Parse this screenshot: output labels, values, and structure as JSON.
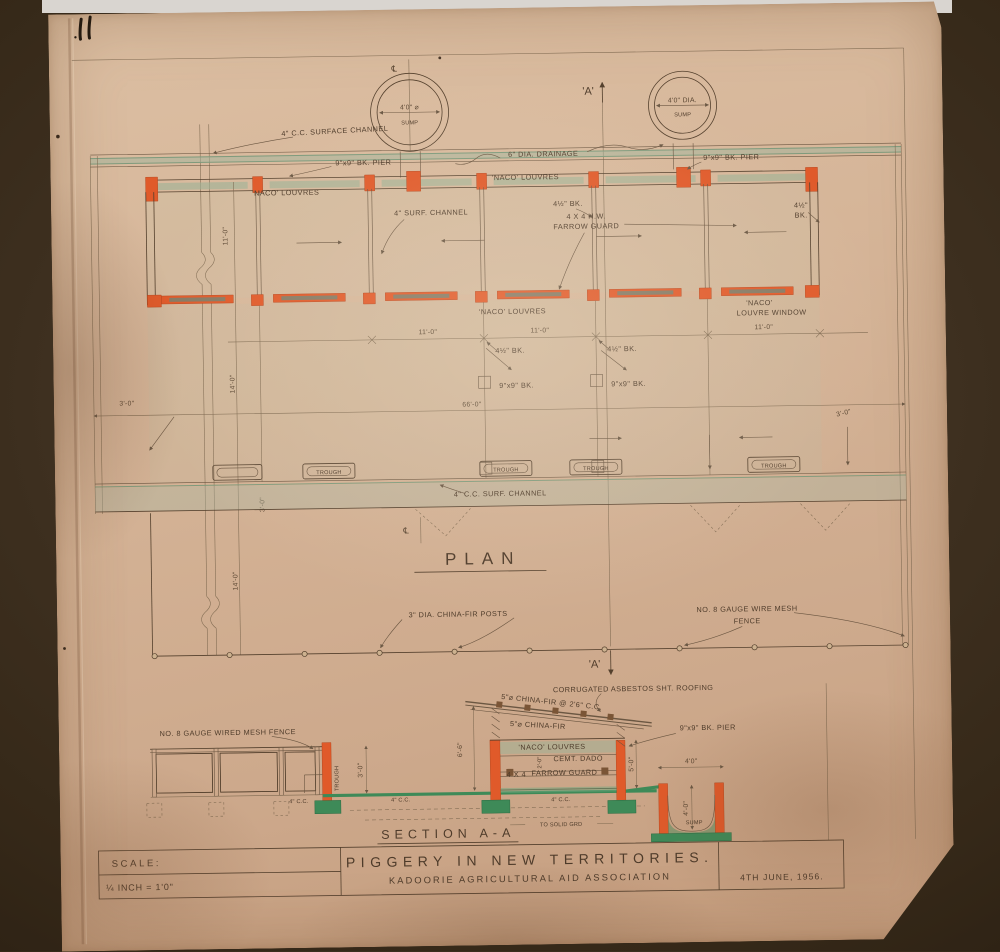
{
  "sheet": {
    "plan_title": "PLAN",
    "section_title": "SECTION  A-A"
  },
  "markers": {
    "centerline": "℄",
    "a": "'A'"
  },
  "plan": {
    "sump_left_dia": "4'0\" ⌀",
    "sump_right_dia": "4'0\" DIA.",
    "sump": "SUMP",
    "surface_channel": "4\" C.C. SURFACE CHANNEL",
    "pier_left": "9\"x9\" BK. PIER",
    "pier_right": "9\"x9\" BK. PIER",
    "drainage": "6\" DIA. DRAINAGE",
    "louvres_top": "'NACO' LOUVRES",
    "louvres_mid": "'NACO' LOUVRES",
    "louvres_pen": "'NACO' LOUVRES",
    "window_1": "'NACO'",
    "window_2": "LOUVRE WINDOW",
    "surf_channel": "4\" SURF. CHANNEL",
    "bk45_top": "4½\" BK.",
    "bk45_edge_1": "4½\"",
    "bk45_edge_2": "BK.",
    "farrow_1": "4 X 4  H.W.",
    "farrow_2": "FARROW GUARD",
    "bk45_a": "4½\" BK.",
    "bk45_b": "4½\" BK.",
    "bk9_a": "9\"x9\" BK.",
    "bk9_b": "9\"x9\" BK.",
    "trough": "TROUGH",
    "surf_channel_btm": "4\" C.C. SURF. CHANNEL",
    "posts": "3\" DIA.  CHINA-FIR POSTS",
    "mesh_1": "NO. 8 GAUGE WIRE MESH",
    "mesh_2": "FENCE",
    "dim_11": "11'-0\"",
    "dim_66": "66'-0\"",
    "dim_3": "3'-0\"",
    "dim_14": "14'-0\""
  },
  "section": {
    "fence": "NO. 8 GAUGE WIRED MESH FENCE",
    "roofing": "CORRUGATED ASBESTOS SHT. ROOFING",
    "rafters": "5\"⌀ CHINA-FIR @ 2'6\" C.C.",
    "post": "5\"⌀ CHINA-FIR",
    "louvres": "'NACO' LOUVRES",
    "pier": "9\"x9\" BK. PIER",
    "dado": "CEMT. DADO",
    "guard_1": "4 X 4",
    "guard_2": "FARROW GUARD",
    "trough": "TROUGH",
    "cc": "4\" C.C.",
    "solid": "TO SOLID GRD",
    "sump": "SUMP",
    "dim_3": "3'-0\"",
    "dim_66h": "6'-6\"",
    "dim_5": "5'-0\"",
    "dim_2": "2'-0\"",
    "dim_4w": "4'0\"",
    "dim_4d": "4'-0\""
  },
  "title_block": {
    "scale_label": "SCALE:",
    "scale_value": "¼ INCH = 1'0\"",
    "title": "PIGGERY  IN  NEW  TERRITORIES.",
    "subtitle": "KADOORIE  AGRICULTURAL  AID  ASSOCIATION",
    "date": "4TH JUNE, 1956."
  },
  "colors": {
    "orange": "#e05a2a",
    "green": "#3e8a58",
    "ink": "#54402d",
    "paper": "#d2b195"
  }
}
